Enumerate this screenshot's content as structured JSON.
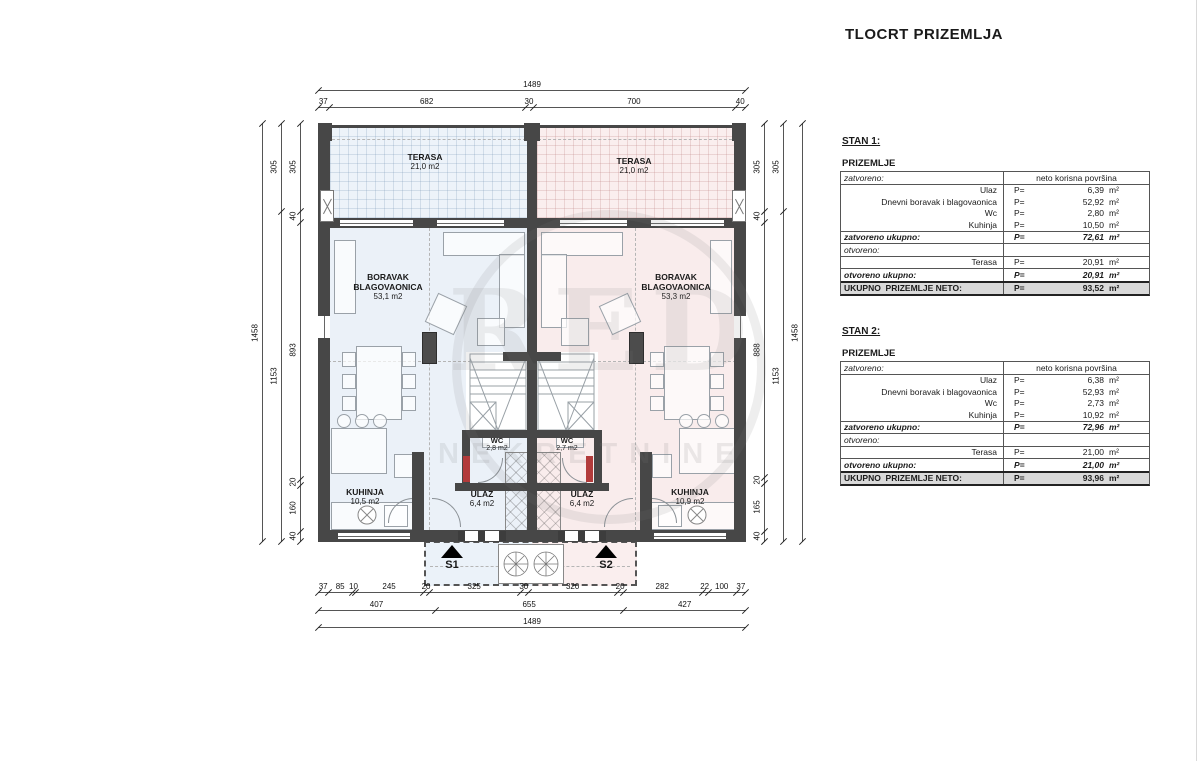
{
  "header": {
    "title": "TLOCRT PRIZEMLJA"
  },
  "colors": {
    "unit_left": "#ebf1f8",
    "unit_right": "#f9ecec",
    "wall": "#474747",
    "door_jamb_red": "#b23b3b",
    "total_row_bg": "#d9d9d9"
  },
  "watermark": {
    "circle_letters": "RED",
    "text": "NEKRETNINE"
  },
  "rooms": [
    {
      "name": "TERASA",
      "area": "21,0 m2"
    },
    {
      "name": "TERASA",
      "area": "21,0 m2"
    },
    {
      "name": "BORAVAK",
      "name2": "BLAGOVAONICA",
      "area": "53,1 m2"
    },
    {
      "name": "BORAVAK",
      "name2": "BLAGOVAONICA",
      "area": "53,3 m2"
    },
    {
      "name": "KUHINJA",
      "area": "10,5 m2"
    },
    {
      "name": "KUHINJA",
      "area": "10,9 m2"
    },
    {
      "name": "ULAZ",
      "area": "6,4 m2"
    },
    {
      "name": "ULAZ",
      "area": "6,4 m2"
    },
    {
      "name": "WC",
      "area": "2,8 m2"
    },
    {
      "name": "WC",
      "area": "2,7 m2"
    }
  ],
  "markers": {
    "s1": "S1",
    "s2": "S2"
  },
  "dimensions": {
    "top": {
      "overall": [
        "1489"
      ],
      "detail": [
        "37",
        "682",
        "30",
        "700",
        "40"
      ]
    },
    "bottom": {
      "detail": [
        "37",
        "85",
        "10",
        "245",
        "20",
        "325",
        "30",
        "320",
        "20",
        "282",
        "22",
        "100",
        "37"
      ],
      "mid": [
        "407",
        "655",
        "427"
      ],
      "overall": [
        "1489"
      ]
    },
    "left": {
      "overall": [
        "1458"
      ],
      "mid": [
        "305",
        "1153"
      ],
      "detail": [
        "305",
        "40",
        "893",
        "20",
        "160",
        "40"
      ]
    },
    "right": {
      "detail": [
        "305",
        "40",
        "888",
        "20",
        "165",
        "40"
      ],
      "mid": [
        "305",
        "1153"
      ],
      "overall": [
        "1458"
      ]
    }
  },
  "tables": [
    {
      "stan": "STAN 1:",
      "floor": "PRIZEMLJE",
      "closed_header": "zatvoreno:",
      "area_header": "neto korisna površina",
      "rows": [
        {
          "label": "Ulaz",
          "p": "P=",
          "value": "6,39",
          "unit": "m²"
        },
        {
          "label": "Dnevni boravak i blagovaonica",
          "p": "P=",
          "value": "52,92",
          "unit": "m²"
        },
        {
          "label": "Wc",
          "p": "P=",
          "value": "2,80",
          "unit": "m²"
        },
        {
          "label": "Kuhinja",
          "p": "P=",
          "value": "10,50",
          "unit": "m²"
        }
      ],
      "closed_total": {
        "label": "zatvoreno ukupno:",
        "p": "P=",
        "value": "72,61",
        "unit": "m²"
      },
      "open_header": "otvoreno:",
      "open_rows": [
        {
          "label": "Terasa",
          "p": "P=",
          "value": "20,91",
          "unit": "m²"
        }
      ],
      "open_total": {
        "label": "otvoreno ukupno:",
        "p": "P=",
        "value": "20,91",
        "unit": "m²"
      },
      "grand_total": {
        "label": "UKUPNO  PRIZEMLJE NETO:",
        "p": "P=",
        "value": "93,52",
        "unit": "m²"
      }
    },
    {
      "stan": "STAN 2:",
      "floor": "PRIZEMLJE",
      "closed_header": "zatvoreno:",
      "area_header": "neto korisna površina",
      "rows": [
        {
          "label": "Ulaz",
          "p": "P=",
          "value": "6,38",
          "unit": "m²"
        },
        {
          "label": "Dnevni boravak i blagovaonica",
          "p": "P=",
          "value": "52,93",
          "unit": "m²"
        },
        {
          "label": "Wc",
          "p": "P=",
          "value": "2,73",
          "unit": "m²"
        },
        {
          "label": "Kuhinja",
          "p": "P=",
          "value": "10,92",
          "unit": "m²"
        }
      ],
      "closed_total": {
        "label": "zatvoreno ukupno:",
        "p": "P=",
        "value": "72,96",
        "unit": "m²"
      },
      "open_header": "otvoreno:",
      "open_rows": [
        {
          "label": "Terasa",
          "p": "P=",
          "value": "21,00",
          "unit": "m²"
        }
      ],
      "open_total": {
        "label": "otvoreno ukupno:",
        "p": "P=",
        "value": "21,00",
        "unit": "m²"
      },
      "grand_total": {
        "label": "UKUPNO  PRIZEMLJE NETO:",
        "p": "P=",
        "value": "93,96",
        "unit": "m²"
      }
    }
  ]
}
